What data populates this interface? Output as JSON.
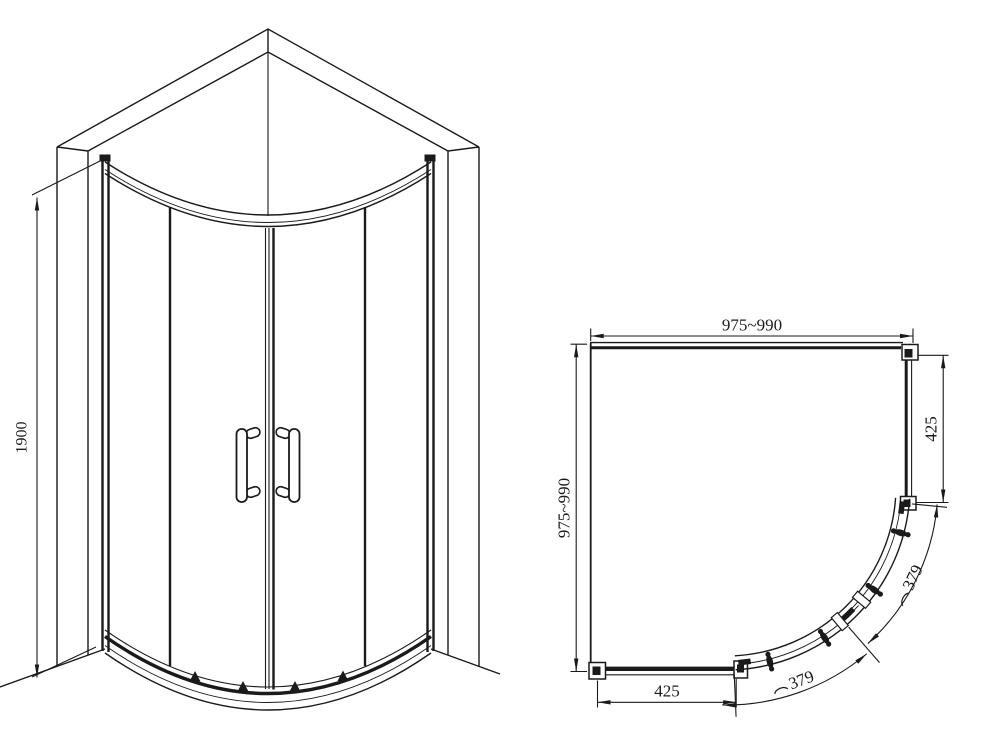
{
  "meta": {
    "background": "#ffffff",
    "line_color": "#1a1a1a",
    "drawing_subject": "quadrant shower enclosure, line drawing, two views"
  },
  "perspective_view": {
    "height_dimension": "1900"
  },
  "plan_view": {
    "width_dimension": "975~990",
    "depth_dimension": "975~990",
    "right_fixed_panel_dimension": "425",
    "bottom_fixed_panel_dimension": "425",
    "upper_door_arc_dimension": "379",
    "lower_door_arc_dimension": "379",
    "icons": {
      "arc_length_symbol": "⌒"
    }
  }
}
